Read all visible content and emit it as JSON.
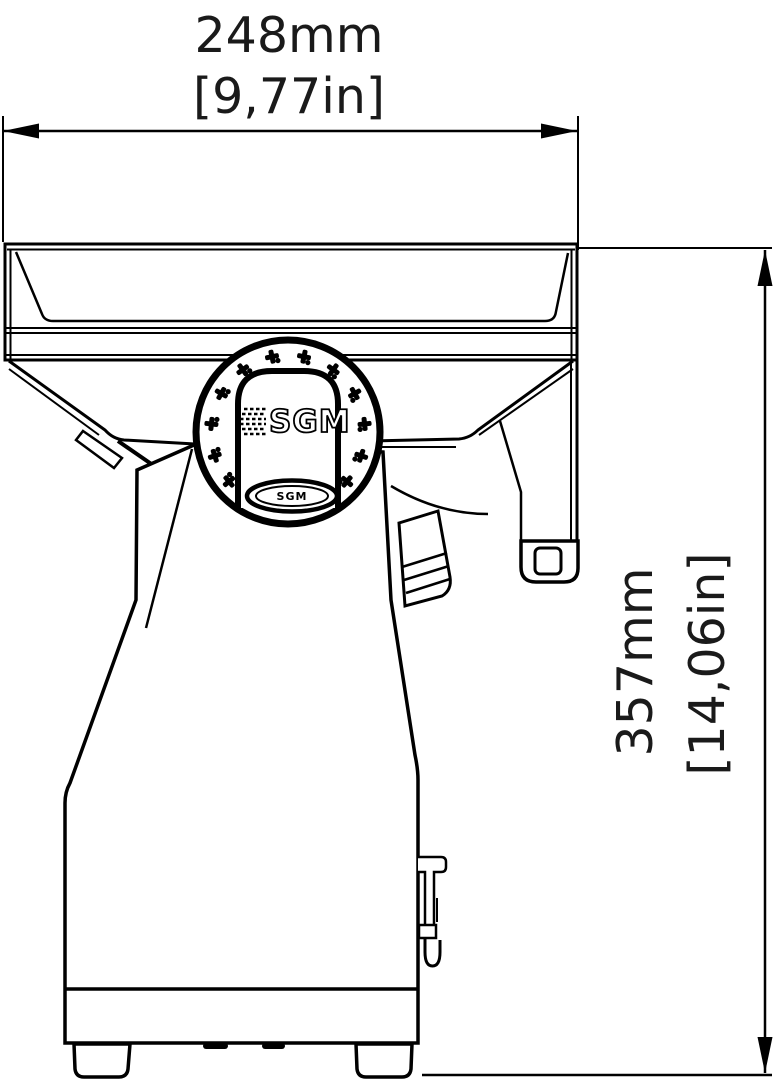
{
  "drawing": {
    "width_dim": {
      "metric": "248mm",
      "imperial": "[9,77in]"
    },
    "height_dim": {
      "metric": "357mm",
      "imperial": "[14,06in]"
    },
    "hub": {
      "logo": "SGM",
      "badge": "SGM"
    },
    "colors": {
      "line": "#000000",
      "background": "#ffffff",
      "text": "#1a1a1a"
    }
  }
}
